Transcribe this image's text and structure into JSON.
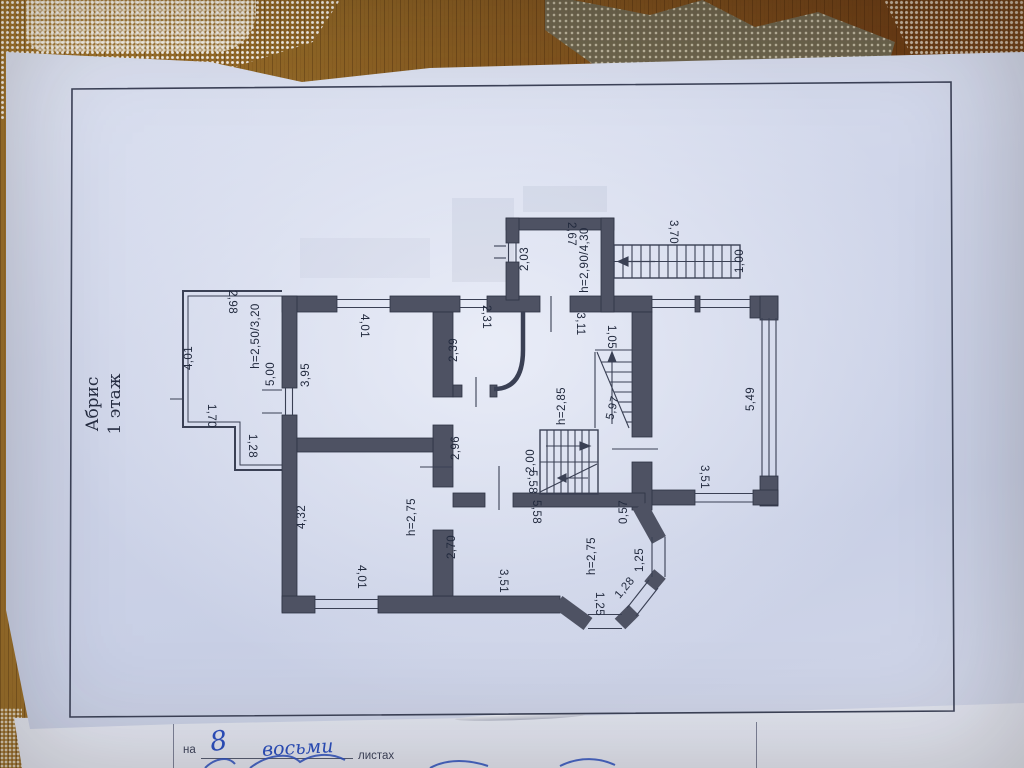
{
  "title": {
    "line1": "Абрис",
    "line2": "1 этаж"
  },
  "plan": {
    "labels": [
      {
        "text": "2,98"
      },
      {
        "text": "4,01"
      },
      {
        "text": "h=2,50/3,20"
      },
      {
        "text": "5,00"
      },
      {
        "text": "3,95"
      },
      {
        "text": "1,70"
      },
      {
        "text": "1,28"
      },
      {
        "text": "4,01"
      },
      {
        "text": "2,39"
      },
      {
        "text": "2,31"
      },
      {
        "text": "2,03"
      },
      {
        "text": "2,67"
      },
      {
        "text": "h=2,90/4,30"
      },
      {
        "text": "3,70"
      },
      {
        "text": "1,00"
      },
      {
        "text": "3,11"
      },
      {
        "text": "1,05"
      },
      {
        "text": "5,97"
      },
      {
        "text": "h=2,85"
      },
      {
        "text": "2,96"
      },
      {
        "text": "2,00"
      },
      {
        "text": "5,58"
      },
      {
        "text": "5,58"
      },
      {
        "text": "2,70"
      },
      {
        "text": "3,51"
      },
      {
        "text": "4,32"
      },
      {
        "text": "h=2,75"
      },
      {
        "text": "4,01"
      },
      {
        "text": "5,49"
      },
      {
        "text": "3,51"
      },
      {
        "text": "0,57"
      },
      {
        "text": "h=2,75"
      },
      {
        "text": "1,25"
      },
      {
        "text": "1,28"
      },
      {
        "text": "1,25"
      }
    ]
  },
  "footer": {
    "preposition": "на",
    "count": "8",
    "count_word": "восьми",
    "suffix": "листах"
  },
  "colors": {
    "wall": "#4e5263",
    "paper": "#cfd5e9",
    "ink": "#222a3e",
    "pen": "#2b4fc0",
    "wood": "#8a5a20"
  }
}
